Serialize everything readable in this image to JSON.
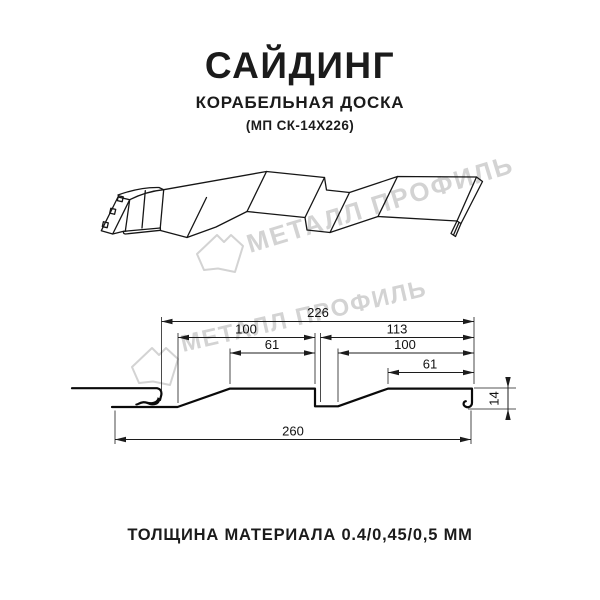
{
  "header": {
    "title": "САЙДИНГ",
    "subtitle": "КОРАБЕЛЬНАЯ ДОСКА",
    "model": "(МП СК-14Х226)"
  },
  "watermark": {
    "text": "МЕТАЛЛ ПРОФИЛЬ",
    "color": "#d3d3d3"
  },
  "diagram": {
    "type": "siding profile cross-section, dimensions in mm",
    "dims": {
      "overall": "226",
      "upper_left": "100",
      "upper_right": "113",
      "mid_left": "61",
      "mid_right": "100",
      "lower_right": "61",
      "height": "14",
      "total": "260"
    }
  },
  "footer": {
    "text": "ТОЛЩИНА МАТЕРИАЛА 0.4/0,45/0,5 ММ"
  }
}
